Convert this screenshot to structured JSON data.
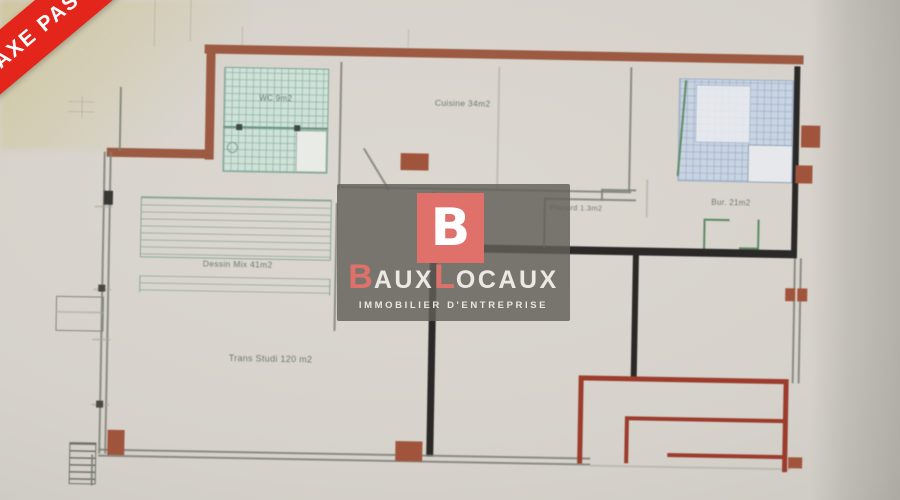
{
  "ribbon": {
    "label": "AXE PAS"
  },
  "watermark": {
    "monogram": "B",
    "brand_b": "B",
    "brand_aux": "AUX",
    "brand_l": "L",
    "brand_ocaux": "OCAUX",
    "tagline": "IMMOBILIER D'ENTREPRISE"
  },
  "plan": {
    "labels": {
      "wc": "WC 9m2",
      "cuisine": "Cuisine 34m2",
      "bureau": "Bur. 21m2",
      "placard": "Placard 1.3m2",
      "atelier": "Dessin Mix 41m2",
      "main_room": "Trans Studi 120 m2"
    }
  },
  "colors": {
    "ribbon": "#e3251b",
    "wall_brown": "#9c5a42",
    "wall_black": "#2b2927",
    "wall_thin": "#7c7f74",
    "tile_teal_bg": "#cfe2d9",
    "tile_blue_bg": "#c9d4e2",
    "red_line": "#9c3c2c",
    "block_brown": "#a1543c",
    "logo_salmon": "#e0716a",
    "green_mark": "#5d8a63",
    "label_ink": "#5c685e"
  }
}
